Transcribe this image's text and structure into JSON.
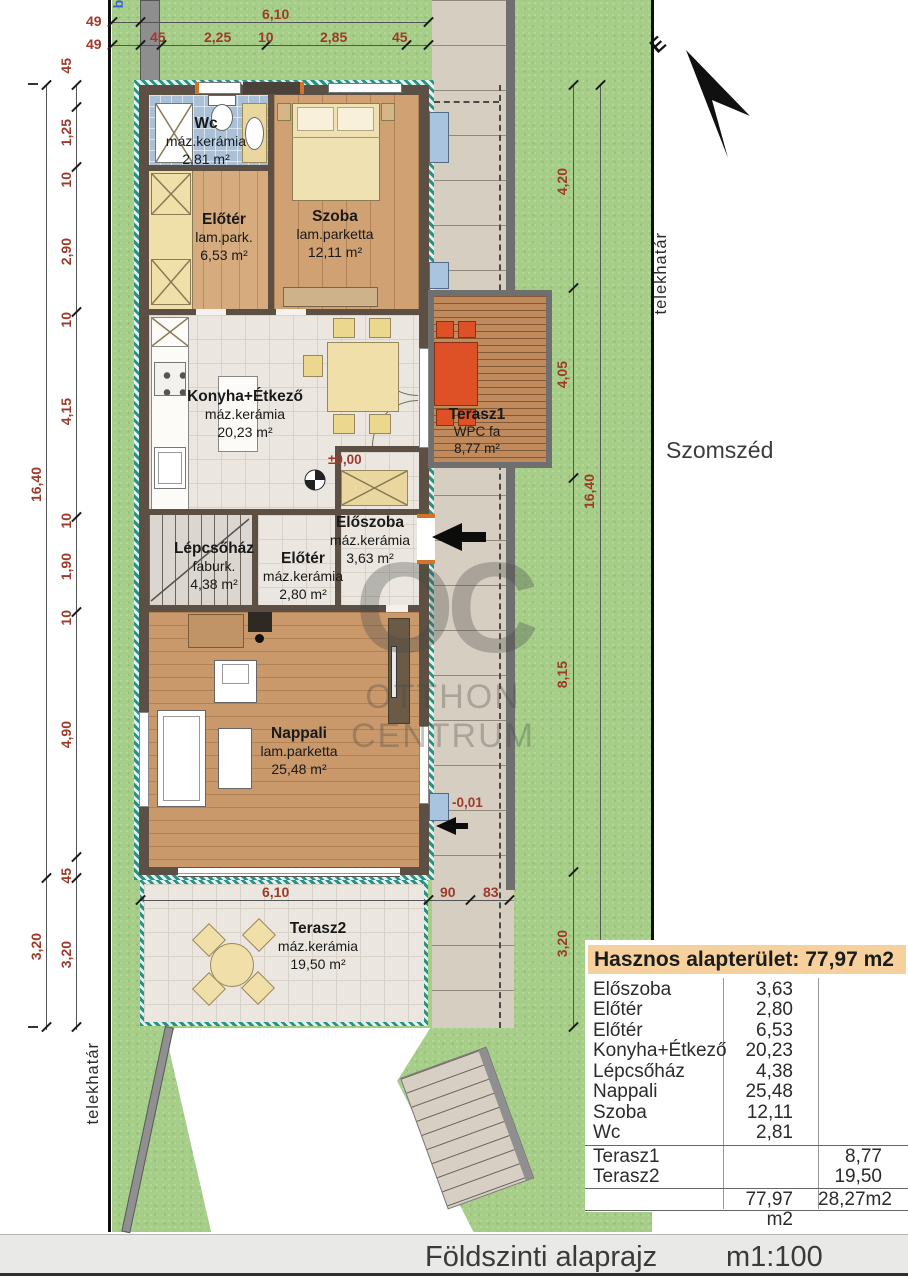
{
  "footer": {
    "title": "Földszinti alaprajz",
    "scale": "m1:100"
  },
  "compass": {
    "north": "É"
  },
  "site": {
    "boundary_left": "telekhatár",
    "boundary_right": "telekhatár",
    "neighbor": "Szomszéd",
    "entry_partial": "be"
  },
  "levels": {
    "ground": "±0,00",
    "terrace": "-0,01"
  },
  "rooms": {
    "wc": {
      "name": "Wc",
      "material": "máz.kerámia",
      "area": "2,81 m²"
    },
    "szoba": {
      "name": "Szoba",
      "material": "lam.parketta",
      "area": "12,11 m²"
    },
    "eloter_upper": {
      "name": "Előtér",
      "material": "lam.park.",
      "area": "6,53 m²"
    },
    "konyha": {
      "name": "Konyha+Étkező",
      "material": "máz.kerámia",
      "area": "20,23 m²"
    },
    "terasz1": {
      "name": "Terasz1",
      "material": "WPC fa",
      "area": "8,77 m²"
    },
    "eloszoba": {
      "name": "Előszoba",
      "material": "máz.kerámia",
      "area": "3,63 m²"
    },
    "eloter_lower": {
      "name": "Előtér",
      "material": "máz.kerámia",
      "area": "2,80 m²"
    },
    "lepcsohaz": {
      "name": "Lépcsőház",
      "material": "faburk.",
      "area": "4,38 m²"
    },
    "nappali": {
      "name": "Nappali",
      "material": "lam.parketta",
      "area": "25,48 m²"
    },
    "terasz2": {
      "name": "Terasz2",
      "material": "máz.kerámia",
      "area": "19,50 m²"
    }
  },
  "dims": {
    "top_total": "6,10",
    "top": [
      "45",
      "2,25",
      "10",
      "2,85",
      "45"
    ],
    "corner_upper": "49",
    "corner_lower": "49",
    "left": [
      "45",
      "1,25",
      "10",
      "2,90",
      "10",
      "4,15",
      "10",
      "1,90",
      "10",
      "4,90",
      "45"
    ],
    "left_total": "16,40",
    "left_terrace_inner": "3,20",
    "left_terrace_outer": "3,20",
    "right": [
      "4,20",
      "4,05",
      "8,15"
    ],
    "right_terrace": "3,20",
    "right_total": "16,40",
    "bottom_total": "6,10",
    "bottom_step1": "90",
    "bottom_step2": "83"
  },
  "area_table": {
    "header": "Hasznos alapterület: 77,97 m2",
    "rows": [
      {
        "name": "Előszoba",
        "indoor": "3,63",
        "outdoor": ""
      },
      {
        "name": "Előtér",
        "indoor": "2,80",
        "outdoor": ""
      },
      {
        "name": "Előtér",
        "indoor": "6,53",
        "outdoor": ""
      },
      {
        "name": "Konyha+Étkező",
        "indoor": "20,23",
        "outdoor": ""
      },
      {
        "name": "Lépcsőház",
        "indoor": "4,38",
        "outdoor": ""
      },
      {
        "name": "Nappali",
        "indoor": "25,48",
        "outdoor": ""
      },
      {
        "name": "Szoba",
        "indoor": "12,11",
        "outdoor": ""
      },
      {
        "name": "Wc",
        "indoor": "2,81",
        "outdoor": ""
      },
      {
        "name": "Terasz1",
        "indoor": "",
        "outdoor": "8,77"
      },
      {
        "name": "Terasz2",
        "indoor": "",
        "outdoor": "19,50"
      }
    ],
    "total_indoor": "77,97 m2",
    "total_outdoor": "28,27m2"
  },
  "watermark": {
    "logo": "OC",
    "line1": "OTTHON",
    "line2": "CENTRUM"
  },
  "colors": {
    "dimension_text": "#9c3a2b",
    "table_header_bg": "#f6d19e",
    "wall": "#5b5043",
    "insulation": "#2c9184",
    "grass": "#a6ce88",
    "terasz1_furniture": "#de5127",
    "window_blue": "#a9c4de"
  }
}
